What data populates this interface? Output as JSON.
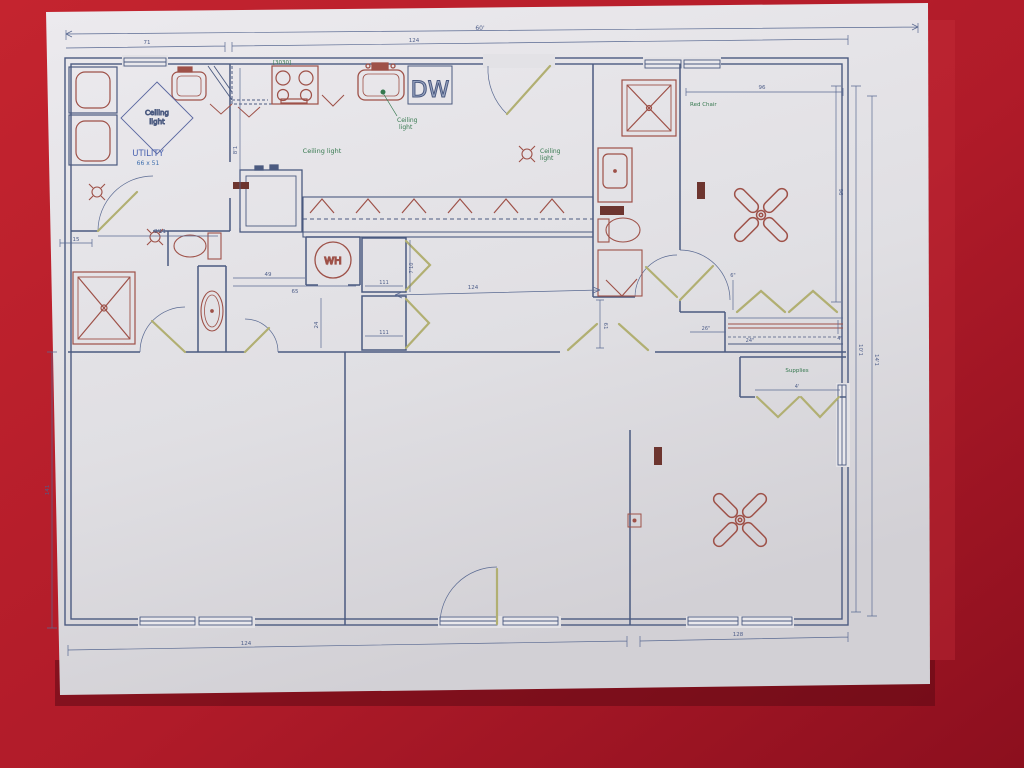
{
  "scene": {
    "description": "Photo of an architectural floor plan on white paper over a red background",
    "background_color": "#a81726",
    "paper_color": "#e3e2e6"
  },
  "palette": {
    "wall_line": "#4b5a80",
    "fixture_line": "#9e5148",
    "door_swing": "#b1af72",
    "green_text": "#35784e",
    "blue_text": "#4a63b0",
    "dimension_text": "#4f5f8a",
    "vent_fill": "#6d352f"
  },
  "labels": {
    "utility": "UTILITY",
    "utility_size": "66 x 51",
    "ceiling": "Ceiling light",
    "ceiling_1": "Ceiling",
    "ceiling_2": "light",
    "red_chair": "Red Chair",
    "supplies": "Supplies",
    "wh": "WH",
    "dw": "DW",
    "window_tag": "[3030]"
  },
  "dimensions": {
    "t_total": "60'",
    "t_left": "71",
    "t_right": "124",
    "b_left": "124",
    "b_right": "128",
    "l_main": "141",
    "l_small": "15",
    "r_1": "96",
    "r_2": "10'1",
    "r_3": "14'1",
    "bed_top": "96",
    "hall": "124",
    "hall_v": "61",
    "u_width": "8'11",
    "k_v": "8'1",
    "wh_a": "49",
    "wh_b": "65",
    "wh_v": "24",
    "cl_w": "111",
    "cl_h": "7'10",
    "rod_26": "26\"",
    "rod_24": "24\"",
    "rod_6": "6\"",
    "rod_4": "4\"",
    "sup_w": "4'"
  }
}
